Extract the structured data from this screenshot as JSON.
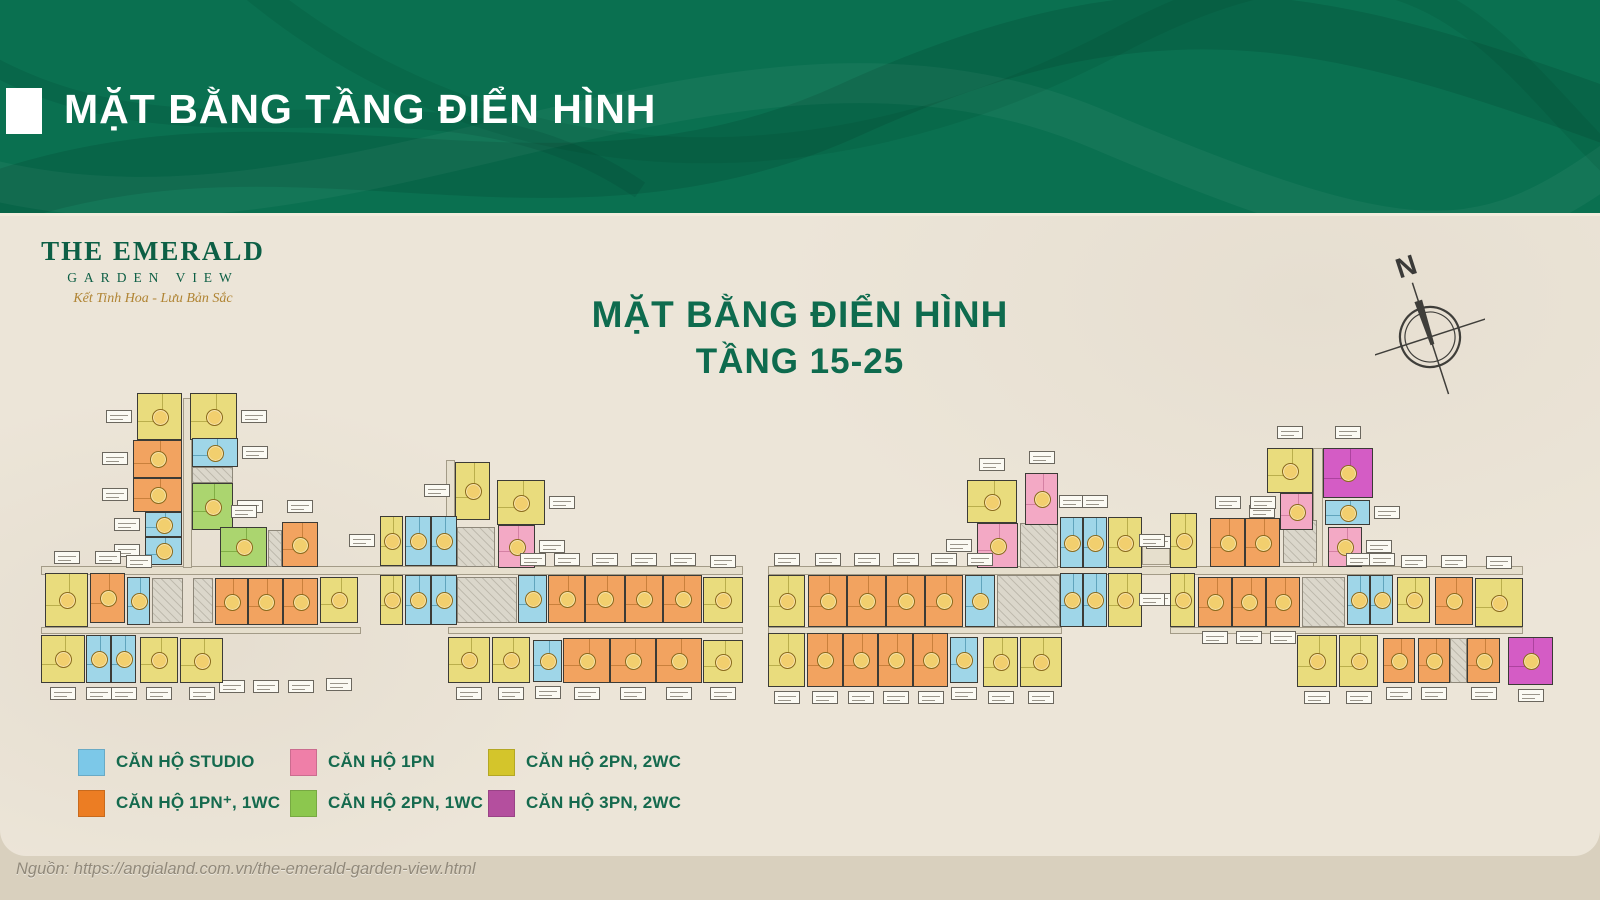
{
  "header": {
    "title": "MẶT BẰNG TẦNG ĐIỂN HÌNH"
  },
  "logo": {
    "line1": "THE EMERALD",
    "line2": "GARDEN VIEW",
    "tagline": "Kết Tinh Hoa - Lưu Bản Sắc"
  },
  "plan_title": {
    "line1": "MẶT BẰNG ĐIỂN HÌNH",
    "line2": "TẦNG 15-25"
  },
  "compass": {
    "label": "N"
  },
  "legend": {
    "items": [
      {
        "label": "CĂN HỘ STUDIO",
        "color": "#7cc8e8"
      },
      {
        "label": "CĂN HỘ 1PN",
        "color": "#ef7fa8"
      },
      {
        "label": "CĂN HỘ 2PN, 2WC",
        "color": "#d4c52b"
      },
      {
        "label": "CĂN HỘ 1PN⁺, 1WC",
        "color": "#ec7d23"
      },
      {
        "label": "CĂN HỘ 2PN, 1WC",
        "color": "#8cc74e"
      },
      {
        "label": "CĂN HỘ 3PN, 2WC",
        "color": "#b44f9e"
      }
    ]
  },
  "footer": {
    "source": "Nguồn: https://angialand.com.vn/the-emerald-garden-view.html"
  },
  "colors": {
    "header_green": "#0a7050",
    "title_green": "#0e6b4e",
    "panel_beige": "#ece5d8",
    "strip_beige": "#d9d0be",
    "badge_gold": "#f2cf6e"
  },
  "floorplan": {
    "unit_types": {
      "st": {
        "name": "studio",
        "fill": "#9fd6e8",
        "line": "#2d7c99"
      },
      "p1": {
        "name": "1pn",
        "fill": "#f3a9c5",
        "line": "#bc5f88"
      },
      "y2": {
        "name": "2pn-2wc",
        "fill": "#e9dc7d",
        "line": "#958a25"
      },
      "o1": {
        "name": "1pn-plus",
        "fill": "#f2a360",
        "line": "#a8651f"
      },
      "g2": {
        "name": "2pn-1wc",
        "fill": "#abd56f",
        "line": "#5d9023"
      },
      "m3": {
        "name": "3pn-2wc",
        "fill": "#d45cc5",
        "line": "#8d2f7f"
      }
    },
    "corridors": [
      [
        41,
        566,
        702,
        9
      ],
      [
        768,
        566,
        755,
        9
      ],
      [
        41,
        627,
        320,
        7
      ],
      [
        448,
        627,
        295,
        7
      ],
      [
        768,
        627,
        294,
        7
      ],
      [
        1170,
        627,
        353,
        7
      ],
      [
        183,
        398,
        9,
        170
      ],
      [
        446,
        460,
        9,
        106
      ],
      [
        1313,
        448,
        10,
        119
      ],
      [
        1142,
        545,
        28,
        20
      ]
    ],
    "cores": [
      [
        152,
        578,
        31,
        45
      ],
      [
        193,
        578,
        20,
        45
      ],
      [
        457,
        577,
        60,
        46
      ],
      [
        457,
        527,
        38,
        40
      ],
      [
        192,
        467,
        41,
        16
      ],
      [
        268,
        530,
        14,
        37
      ],
      [
        997,
        575,
        63,
        52
      ],
      [
        1020,
        523,
        38,
        45
      ],
      [
        1283,
        520,
        34,
        43
      ],
      [
        1302,
        577,
        43,
        50
      ],
      [
        1450,
        638,
        17,
        45
      ]
    ],
    "units": [
      [
        137,
        393,
        45,
        47,
        "y2",
        "l"
      ],
      [
        190,
        393,
        47,
        47,
        "y2",
        "r"
      ],
      [
        133,
        440,
        49,
        38,
        "o1",
        "l"
      ],
      [
        133,
        478,
        49,
        34,
        "o1",
        "l"
      ],
      [
        192,
        438,
        46,
        29,
        "st",
        "r"
      ],
      [
        192,
        483,
        41,
        47,
        "g2",
        "r"
      ],
      [
        145,
        512,
        37,
        25,
        "st",
        "l"
      ],
      [
        145,
        537,
        37,
        28,
        "st",
        "l"
      ],
      [
        220,
        527,
        47,
        40,
        "g2",
        "t"
      ],
      [
        282,
        522,
        36,
        45,
        "o1",
        "t"
      ],
      [
        45,
        573,
        43,
        54,
        "y2",
        "t"
      ],
      [
        90,
        573,
        35,
        50,
        "o1",
        "t"
      ],
      [
        127,
        577,
        23,
        48,
        "st",
        "t"
      ],
      [
        215,
        578,
        33,
        47,
        "o1",
        "B"
      ],
      [
        248,
        578,
        35,
        47,
        "o1",
        "B"
      ],
      [
        283,
        578,
        35,
        47,
        "o1",
        "B"
      ],
      [
        320,
        577,
        38,
        46,
        "y2",
        "B"
      ],
      [
        41,
        635,
        44,
        48,
        "y2",
        "b"
      ],
      [
        86,
        635,
        25,
        48,
        "st",
        "b"
      ],
      [
        111,
        635,
        25,
        48,
        "st",
        "b"
      ],
      [
        140,
        637,
        38,
        46,
        "y2",
        "b"
      ],
      [
        180,
        638,
        43,
        45,
        "y2",
        "b"
      ],
      [
        455,
        462,
        35,
        58,
        "y2",
        "l"
      ],
      [
        497,
        480,
        48,
        45,
        "y2",
        "r"
      ],
      [
        498,
        525,
        37,
        43,
        "p1",
        "r"
      ],
      [
        380,
        516,
        23,
        50,
        "y2",
        "l"
      ],
      [
        405,
        516,
        26,
        50,
        "st",
        ""
      ],
      [
        431,
        516,
        26,
        50,
        "st",
        ""
      ],
      [
        380,
        575,
        23,
        50,
        "y2",
        ""
      ],
      [
        405,
        575,
        26,
        50,
        "st",
        ""
      ],
      [
        431,
        575,
        26,
        50,
        "st",
        ""
      ],
      [
        518,
        575,
        29,
        48,
        "st",
        "t"
      ],
      [
        548,
        575,
        37,
        48,
        "o1",
        "t"
      ],
      [
        585,
        575,
        40,
        48,
        "o1",
        "t"
      ],
      [
        625,
        575,
        38,
        48,
        "o1",
        "t"
      ],
      [
        663,
        575,
        39,
        48,
        "o1",
        "t"
      ],
      [
        703,
        577,
        40,
        46,
        "y2",
        "t"
      ],
      [
        448,
        637,
        42,
        46,
        "y2",
        "b"
      ],
      [
        492,
        637,
        38,
        46,
        "y2",
        "b"
      ],
      [
        533,
        640,
        29,
        42,
        "st",
        "b"
      ],
      [
        563,
        638,
        47,
        45,
        "o1",
        "b"
      ],
      [
        610,
        638,
        46,
        45,
        "o1",
        "b"
      ],
      [
        656,
        638,
        46,
        45,
        "o1",
        "b"
      ],
      [
        703,
        640,
        40,
        43,
        "y2",
        "b"
      ],
      [
        967,
        480,
        50,
        43,
        "y2",
        "t"
      ],
      [
        1025,
        473,
        33,
        52,
        "p1",
        "t"
      ],
      [
        977,
        523,
        41,
        45,
        "p1",
        "l"
      ],
      [
        1060,
        517,
        23,
        51,
        "st",
        "t"
      ],
      [
        1083,
        517,
        24,
        51,
        "st",
        "t"
      ],
      [
        1108,
        517,
        34,
        51,
        "y2",
        "r"
      ],
      [
        1060,
        573,
        23,
        54,
        "st",
        ""
      ],
      [
        1083,
        573,
        24,
        54,
        "st",
        ""
      ],
      [
        1108,
        573,
        34,
        54,
        "y2",
        "r"
      ],
      [
        768,
        575,
        37,
        52,
        "y2",
        "t"
      ],
      [
        808,
        575,
        39,
        52,
        "o1",
        "t"
      ],
      [
        847,
        575,
        39,
        52,
        "o1",
        "t"
      ],
      [
        886,
        575,
        39,
        52,
        "o1",
        "t"
      ],
      [
        925,
        575,
        38,
        52,
        "o1",
        "t"
      ],
      [
        965,
        575,
        30,
        52,
        "st",
        "t"
      ],
      [
        768,
        633,
        37,
        54,
        "y2",
        "b"
      ],
      [
        807,
        633,
        36,
        54,
        "o1",
        "b"
      ],
      [
        843,
        633,
        35,
        54,
        "o1",
        "b"
      ],
      [
        878,
        633,
        35,
        54,
        "o1",
        "b"
      ],
      [
        913,
        633,
        35,
        54,
        "o1",
        "b"
      ],
      [
        950,
        637,
        28,
        46,
        "st",
        "b"
      ],
      [
        983,
        637,
        35,
        50,
        "y2",
        "b"
      ],
      [
        1020,
        637,
        42,
        50,
        "y2",
        "b"
      ],
      [
        1267,
        448,
        46,
        45,
        "y2",
        "t"
      ],
      [
        1323,
        448,
        50,
        50,
        "m3",
        "t"
      ],
      [
        1280,
        493,
        33,
        37,
        "p1",
        "l"
      ],
      [
        1325,
        500,
        45,
        25,
        "st",
        "r"
      ],
      [
        1328,
        527,
        34,
        40,
        "p1",
        "r"
      ],
      [
        1170,
        513,
        27,
        55,
        "y2",
        "l"
      ],
      [
        1210,
        518,
        35,
        49,
        "o1",
        "t"
      ],
      [
        1245,
        518,
        35,
        49,
        "o1",
        "t"
      ],
      [
        1170,
        573,
        25,
        54,
        "y2",
        "l"
      ],
      [
        1198,
        577,
        34,
        50,
        "o1",
        "b"
      ],
      [
        1232,
        577,
        34,
        50,
        "o1",
        "b"
      ],
      [
        1266,
        577,
        34,
        50,
        "o1",
        "b"
      ],
      [
        1347,
        575,
        23,
        50,
        "st",
        "t"
      ],
      [
        1370,
        575,
        23,
        50,
        "st",
        "t"
      ],
      [
        1397,
        577,
        33,
        46,
        "y2",
        "t"
      ],
      [
        1435,
        577,
        38,
        48,
        "o1",
        "t"
      ],
      [
        1475,
        578,
        48,
        49,
        "y2",
        "t"
      ],
      [
        1297,
        635,
        40,
        52,
        "y2",
        "b"
      ],
      [
        1339,
        635,
        39,
        52,
        "y2",
        "b"
      ],
      [
        1383,
        638,
        32,
        45,
        "o1",
        "b"
      ],
      [
        1418,
        638,
        32,
        45,
        "o1",
        "b"
      ],
      [
        1467,
        638,
        33,
        45,
        "o1",
        "b"
      ],
      [
        1508,
        637,
        45,
        48,
        "m3",
        "b"
      ]
    ]
  }
}
